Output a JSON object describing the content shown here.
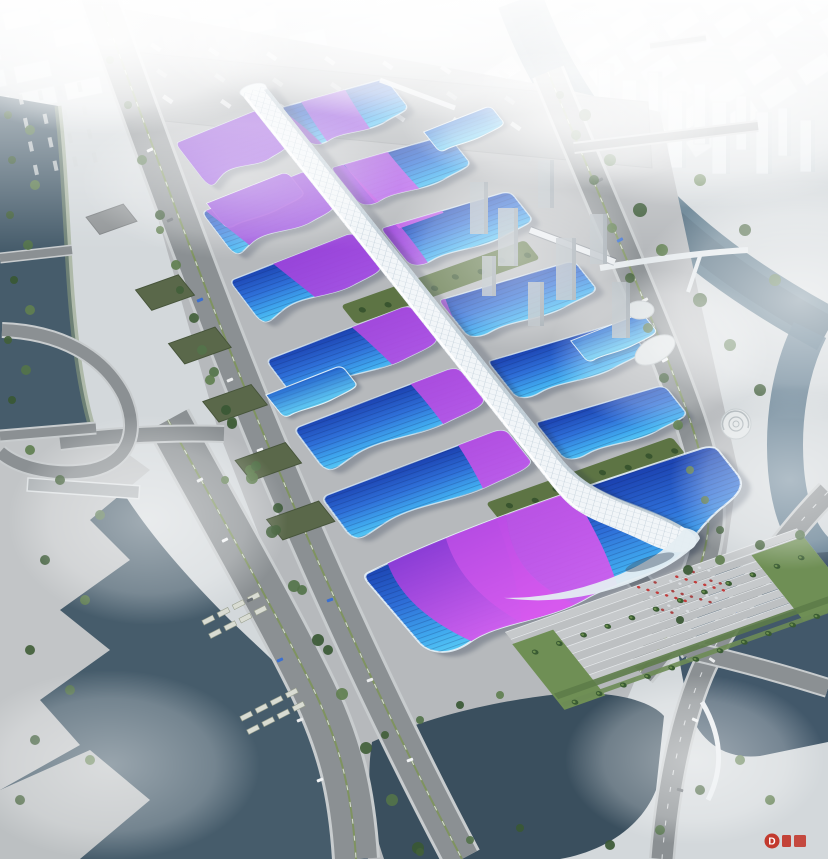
{
  "meta": {
    "title": "Aerial architectural rendering of a large exhibition and convention center complex",
    "type": "architectural-aerial-rendering"
  },
  "watermark": {
    "logo": "D",
    "color": "#c23a2e"
  },
  "scene": {
    "subject": "Exhibition center with wavy blue hall roofs, purple ribbon graphics and a white quilted central spine walkway",
    "complex": {
      "hall_rows_west": 6,
      "hall_rows_east": 6,
      "accent_halls": 4,
      "grand_south_hall": true,
      "central_spine": "white quilted ETFE canopy walkway running the full length",
      "green_courtyards": 2,
      "entrance_plaza": "stepped plaza southeast with palm trees, lawns and a red-flag crowd"
    },
    "environment": {
      "north": "truck marshalling lot and hazy white city blocks",
      "east": "river with bridges, tower cluster and white city in fog",
      "west": "tree-lined boulevard, elevated viaduct, bus lots and dark canal with stepped banks",
      "south": "dark ponds crossed by riverside road and pedestrian bridge"
    }
  },
  "palette": {
    "haze": "#f4f7f8",
    "pavement": "#b6b9bc",
    "road": "#8b9093",
    "road_casing": "#c8ccce",
    "water_dark": "#3a4f5e",
    "water_mid": "#465c6b",
    "water_river": "#5d7a8c",
    "tree": "#42603a",
    "lawn": "#6f8f55",
    "green_roof": "#5a684a",
    "roof_blue_deep": "#1a3fae",
    "roof_blue": "#2e6fd8",
    "roof_cyan": "#56c9f5",
    "ribbon_purple": "#8a3ad6",
    "ribbon_magenta": "#d55bee",
    "spine_white": "#f1f5f8",
    "crowd_red": "#c23b3b"
  }
}
